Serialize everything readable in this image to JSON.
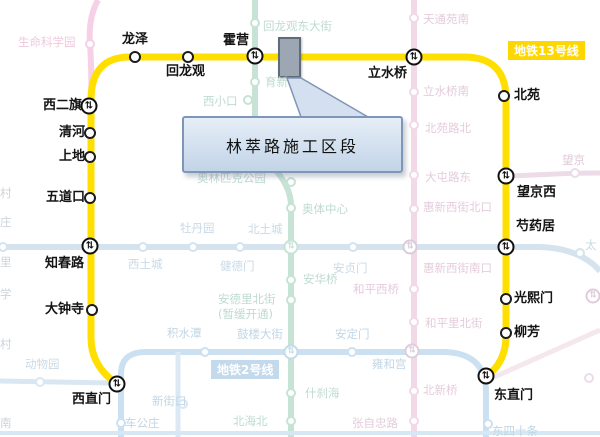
{
  "canvas": {
    "w": 600,
    "h": 437,
    "bg": "#ffffff"
  },
  "transfer_glyph": "⇅",
  "line13": {
    "name": "地铁13号线",
    "color": "#FFDF00",
    "width": 7,
    "path": "M 117 384 Q 91 366 91 338 L 91 100 Q 91 57 130 57 L 464 57 Q 506 57 506 99 L 506 336 Q 506 362 486 377",
    "badge": {
      "text": "地铁13号线",
      "bg": "#FFD700"
    },
    "stations": [
      {
        "name": "西直门",
        "x": 117,
        "y": 384,
        "t": true,
        "label": [
          72,
          393
        ]
      },
      {
        "name": "大钟寺",
        "x": 92,
        "y": 310,
        "t": false,
        "label": [
          45,
          303
        ]
      },
      {
        "name": "知春路",
        "x": 90,
        "y": 246,
        "t": true,
        "label": [
          45,
          257
        ]
      },
      {
        "name": "五道口",
        "x": 90,
        "y": 198,
        "t": false,
        "label": [
          46,
          191
        ]
      },
      {
        "name": "上地",
        "x": 90,
        "y": 157,
        "t": false,
        "label": [
          59,
          150
        ]
      },
      {
        "name": "清河",
        "x": 90,
        "y": 133,
        "t": false,
        "label": [
          59,
          126
        ]
      },
      {
        "name": "西二旗",
        "x": 89,
        "y": 106,
        "t": true,
        "label": [
          43,
          99
        ]
      },
      {
        "name": "龙泽",
        "x": 135,
        "y": 57,
        "t": false,
        "label": [
          122,
          33
        ]
      },
      {
        "name": "回龙观",
        "x": 188,
        "y": 57,
        "t": false,
        "label": [
          166,
          65
        ]
      },
      {
        "name": "霍营",
        "x": 255,
        "y": 56,
        "t": true,
        "label": [
          223,
          34
        ]
      },
      {
        "name": "立水桥",
        "x": 414,
        "y": 57,
        "t": true,
        "label": [
          368,
          67
        ]
      },
      {
        "name": "北苑",
        "x": 504,
        "y": 96,
        "t": false,
        "label": [
          514,
          89
        ]
      },
      {
        "name": "望京西",
        "x": 506,
        "y": 176,
        "t": true,
        "label": [
          517,
          186
        ]
      },
      {
        "name": "芍药居",
        "x": 506,
        "y": 247,
        "t": true,
        "label": [
          516,
          220
        ]
      },
      {
        "name": "光熙门",
        "x": 506,
        "y": 299,
        "t": false,
        "label": [
          514,
          292
        ]
      },
      {
        "name": "柳芳",
        "x": 506,
        "y": 333,
        "t": false,
        "label": [
          514,
          326
        ]
      },
      {
        "name": "东直门",
        "x": 486,
        "y": 376,
        "t": true,
        "label": [
          494,
          389
        ]
      }
    ]
  },
  "line2_badge": {
    "text": "地铁2号线",
    "bg": "#c3d9ec"
  },
  "construction": {
    "rect_fill": "#9da7b3",
    "rect_border": "#5f6b78",
    "pointer_points": "287,78 301,78 368,117 301,117",
    "pointer_fill": "#d4e0ef",
    "pointer_border": "#8096b6",
    "callout": {
      "text": "林萃路施工区段"
    }
  },
  "bg_lines": [
    {
      "path": "M 492 378 L 600 330",
      "color": "#f5e7ee",
      "w": 5
    },
    {
      "path": "M 98 0 Q 88 18 90 44 Q 92 75 91 100",
      "color": "#f6d0e4",
      "w": 6
    },
    {
      "path": "M 255 0 L 255 118 Q 255 148 272 166 Q 291 186 291 206 L 291 437",
      "color": "#c6e3d6",
      "w": 6
    },
    {
      "path": "M 0 247 L 540 247 Q 574 248 594 265 L 600 271",
      "color": "#d4e3ee",
      "w": 6
    },
    {
      "path": "M 414 0 L 414 437",
      "color": "#f1d9e8",
      "w": 6
    },
    {
      "path": "M 510 176 L 556 174 Q 575 173 600 173",
      "color": "#eddbe7",
      "w": 5
    },
    {
      "path": "M 121 437 L 121 374 Q 121 352 146 352 L 442 352 Q 486 352 486 392 L 486 437",
      "color": "#cbe0f0",
      "w": 6
    },
    {
      "path": "M 0 381 L 112 383",
      "color": "#d8e7f2",
      "w": 5
    },
    {
      "path": "M 178 352 L 178 437",
      "color": "#dce9f3",
      "w": 5
    },
    {
      "path": "M 0 433 L 600 433",
      "color": "#d6e8f3",
      "w": 4
    }
  ],
  "bg_stations": [
    {
      "x": 255,
      "y": 23,
      "c": "#c6e3d6"
    },
    {
      "x": 255,
      "y": 82,
      "c": "#c6e3d6"
    },
    {
      "x": 248,
      "y": 100,
      "c": "#c6e3d6"
    },
    {
      "x": 291,
      "y": 182,
      "c": "#c6e3d6"
    },
    {
      "x": 291,
      "y": 208,
      "c": "#c6e3d6"
    },
    {
      "x": 291,
      "y": 247,
      "c": "#c6e3d6",
      "t": true
    },
    {
      "x": 291,
      "y": 280,
      "c": "#c6e3d6"
    },
    {
      "x": 291,
      "y": 300,
      "c": "#c6e3d6"
    },
    {
      "x": 291,
      "y": 352,
      "c": "#c2dce9",
      "t": true
    },
    {
      "x": 291,
      "y": 393,
      "c": "#c6e3d6"
    },
    {
      "x": 291,
      "y": 421,
      "c": "#c6e3d6"
    },
    {
      "x": 3,
      "y": 247,
      "c": "#d4e3ee"
    },
    {
      "x": 143,
      "y": 247,
      "c": "#d4e3ee"
    },
    {
      "x": 193,
      "y": 247,
      "c": "#d4e3ee"
    },
    {
      "x": 240,
      "y": 247,
      "c": "#d4e3ee"
    },
    {
      "x": 353,
      "y": 247,
      "c": "#d4e3ee"
    },
    {
      "x": 410,
      "y": 247,
      "c": "#d9cbd9",
      "t": true
    },
    {
      "x": 580,
      "y": 253,
      "c": "#d4e3ee"
    },
    {
      "x": 414,
      "y": 18,
      "c": "#f1d9e8"
    },
    {
      "x": 414,
      "y": 92,
      "c": "#f1d9e8"
    },
    {
      "x": 414,
      "y": 125,
      "c": "#f1d9e8"
    },
    {
      "x": 414,
      "y": 175,
      "c": "#f1d9e8"
    },
    {
      "x": 414,
      "y": 209,
      "c": "#f1d9e8"
    },
    {
      "x": 414,
      "y": 289,
      "c": "#f1d9e8"
    },
    {
      "x": 414,
      "y": 322,
      "c": "#f1d9e8"
    },
    {
      "x": 412,
      "y": 351,
      "c": "#dccede",
      "t": true
    },
    {
      "x": 414,
      "y": 391,
      "c": "#f1d9e8"
    },
    {
      "x": 414,
      "y": 421,
      "c": "#f1d9e8"
    },
    {
      "x": 205,
      "y": 352,
      "c": "#cbe0f0"
    },
    {
      "x": 352,
      "y": 352,
      "c": "#cbe0f0"
    },
    {
      "x": 121,
      "y": 423,
      "c": "#cbe0f0"
    },
    {
      "x": 488,
      "y": 424,
      "c": "#cbe0f0"
    },
    {
      "x": 40,
      "y": 382,
      "c": "#d8e7f2"
    },
    {
      "x": 183,
      "y": 404,
      "c": "#d8e7f2"
    },
    {
      "x": 575,
      "y": 173,
      "c": "#eddbe7"
    },
    {
      "x": 593,
      "y": 296,
      "c": "#e0ccd8",
      "t": true
    },
    {
      "x": 589,
      "y": 378,
      "c": "#eddbe7"
    },
    {
      "x": 90,
      "y": 44,
      "c": "#f6d0e4"
    }
  ],
  "bg_labels": [
    {
      "text": "回龙观东大街",
      "x": 263,
      "y": 20,
      "c": "#bedbd0"
    },
    {
      "text": "育新",
      "x": 265,
      "y": 76,
      "c": "#bedbd0"
    },
    {
      "text": "西小口",
      "x": 203,
      "y": 95,
      "c": "#bedbd0"
    },
    {
      "text": "奥林匹克公园",
      "x": 197,
      "y": 172,
      "c": "#bedbd0"
    },
    {
      "text": "奥体中心",
      "x": 302,
      "y": 203,
      "c": "#bedbd0"
    },
    {
      "text": "安德里北街",
      "x": 218,
      "y": 293,
      "c": "#bedbd0"
    },
    {
      "text": "(暂缓开通)",
      "x": 218,
      "y": 308,
      "c": "#bedbd0"
    },
    {
      "text": "什刹海",
      "x": 305,
      "y": 387,
      "c": "#bedbd0"
    },
    {
      "text": "北海北",
      "x": 233,
      "y": 415,
      "c": "#bedbd0"
    },
    {
      "text": "安华桥",
      "x": 303,
      "y": 273,
      "c": "#bedbd0"
    },
    {
      "text": "北土城",
      "x": 248,
      "y": 223,
      "c": "#c9dae6"
    },
    {
      "text": "牡丹园",
      "x": 180,
      "y": 222,
      "c": "#c9dae6"
    },
    {
      "text": "西土城",
      "x": 128,
      "y": 258,
      "c": "#c9dae6"
    },
    {
      "text": "健德门",
      "x": 220,
      "y": 260,
      "c": "#c9dae6"
    },
    {
      "text": "安贞门",
      "x": 333,
      "y": 262,
      "c": "#c9dae6"
    },
    {
      "text": "太",
      "x": 585,
      "y": 239,
      "c": "#c9dae6"
    },
    {
      "text": "天通苑南",
      "x": 423,
      "y": 13,
      "c": "#e5ccdc"
    },
    {
      "text": "立水桥南",
      "x": 423,
      "y": 85,
      "c": "#e5ccdc"
    },
    {
      "text": "北苑路北",
      "x": 425,
      "y": 122,
      "c": "#e5ccdc"
    },
    {
      "text": "大屯路东",
      "x": 425,
      "y": 171,
      "c": "#e5ccdc"
    },
    {
      "text": "惠新西街北口",
      "x": 423,
      "y": 201,
      "c": "#e5ccdc"
    },
    {
      "text": "惠新西街南口",
      "x": 423,
      "y": 262,
      "c": "#e5ccdc"
    },
    {
      "text": "和平西桥",
      "x": 353,
      "y": 283,
      "c": "#e5ccdc"
    },
    {
      "text": "和平里北街",
      "x": 425,
      "y": 317,
      "c": "#e5ccdc"
    },
    {
      "text": "北新桥",
      "x": 423,
      "y": 384,
      "c": "#e5ccdc"
    },
    {
      "text": "张自忠路",
      "x": 352,
      "y": 417,
      "c": "#e5ccdc"
    },
    {
      "text": "雍和宫",
      "x": 372,
      "y": 358,
      "c": "#c0d6e6"
    },
    {
      "text": "安定门",
      "x": 335,
      "y": 328,
      "c": "#c0d6e6"
    },
    {
      "text": "鼓楼大街",
      "x": 237,
      "y": 328,
      "c": "#c0d6e6"
    },
    {
      "text": "积水潭",
      "x": 167,
      "y": 327,
      "c": "#c0d6e6"
    },
    {
      "text": "新街口",
      "x": 152,
      "y": 395,
      "c": "#c0d6e6"
    },
    {
      "text": "车公庄",
      "x": 125,
      "y": 417,
      "c": "#c0d6e6"
    },
    {
      "text": "东四十条",
      "x": 492,
      "y": 425,
      "c": "#c0d6e6"
    },
    {
      "text": "动物园",
      "x": 25,
      "y": 358,
      "c": "#c9dae6"
    },
    {
      "text": "望京",
      "x": 562,
      "y": 154,
      "c": "#dcc9d6"
    },
    {
      "text": "生命科学园",
      "x": 18,
      "y": 36,
      "c": "#efc9de"
    },
    {
      "text": "村",
      "x": 0,
      "y": 187,
      "c": "#ccd4da"
    },
    {
      "text": "庄",
      "x": 0,
      "y": 216,
      "c": "#ccd4da"
    },
    {
      "text": "里",
      "x": 0,
      "y": 256,
      "c": "#ccd4da"
    },
    {
      "text": "学",
      "x": 0,
      "y": 288,
      "c": "#ccd4da"
    },
    {
      "text": "村",
      "x": 0,
      "y": 338,
      "c": "#ccd4da"
    },
    {
      "text": "南",
      "x": 0,
      "y": 417,
      "c": "#ccd4da"
    }
  ]
}
